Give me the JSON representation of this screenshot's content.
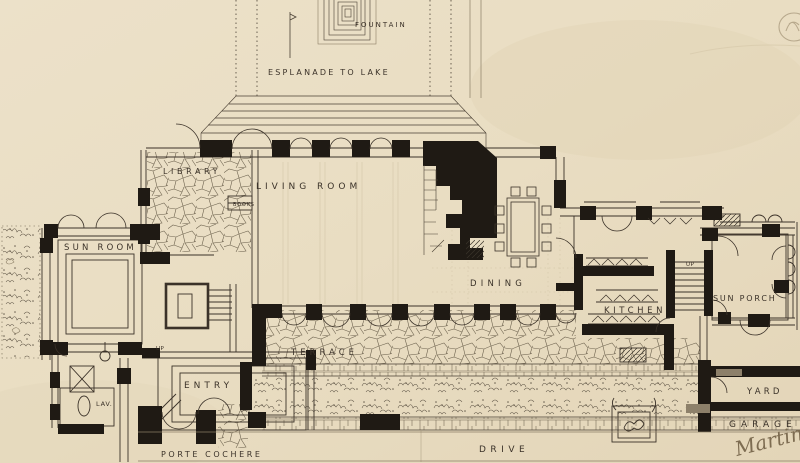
{
  "drawing": {
    "type": "hand-drawn architectural floor plan",
    "labels": {
      "fountain": "FOUNTAIN",
      "esplanade": "ESPLANADE TO LAKE",
      "library": "LIBRARY",
      "books": "BOOKS",
      "living_room": "LIVING ROOM",
      "sun_room": "SUN ROOM",
      "dining": "DINING",
      "kitchen": "KITCHEN",
      "sun_porch": "SUN PORCH",
      "up_kitchen": "UP",
      "terrace": "TERRACE",
      "entry": "ENTRY",
      "up_entry": "UP",
      "lav": "LAV.",
      "yard": "YARD",
      "garage": "GARAGE",
      "porte_cochere": "PORTE COCHERE",
      "drive": "DRIVE"
    },
    "annotations": {
      "signature": "Martin"
    },
    "colors": {
      "paper": "#e9ddc3",
      "ink": "#3b3229",
      "poche_black": "#1f1a14",
      "faint_guide": "#cfc2a3",
      "pencil": "#b7a88c"
    }
  }
}
